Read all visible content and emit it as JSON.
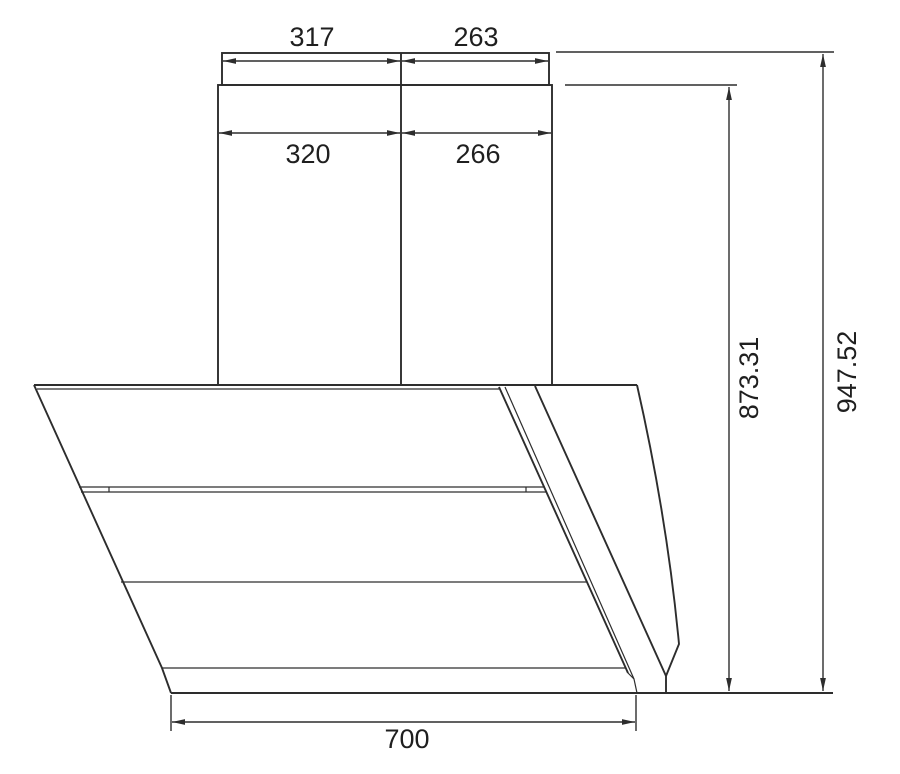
{
  "page": {
    "background": "#ffffff",
    "line_color": "#2d2d2d",
    "text_color": "#1f1f1f"
  },
  "dimensions": {
    "chimney_top_left_width": "317",
    "chimney_top_right_width": "263",
    "chimney_base_left_width": "320",
    "chimney_base_right_width": "266",
    "hood_to_chimney_height": "873.31",
    "overall_height": "947.52",
    "hood_bottom_width": "700"
  }
}
